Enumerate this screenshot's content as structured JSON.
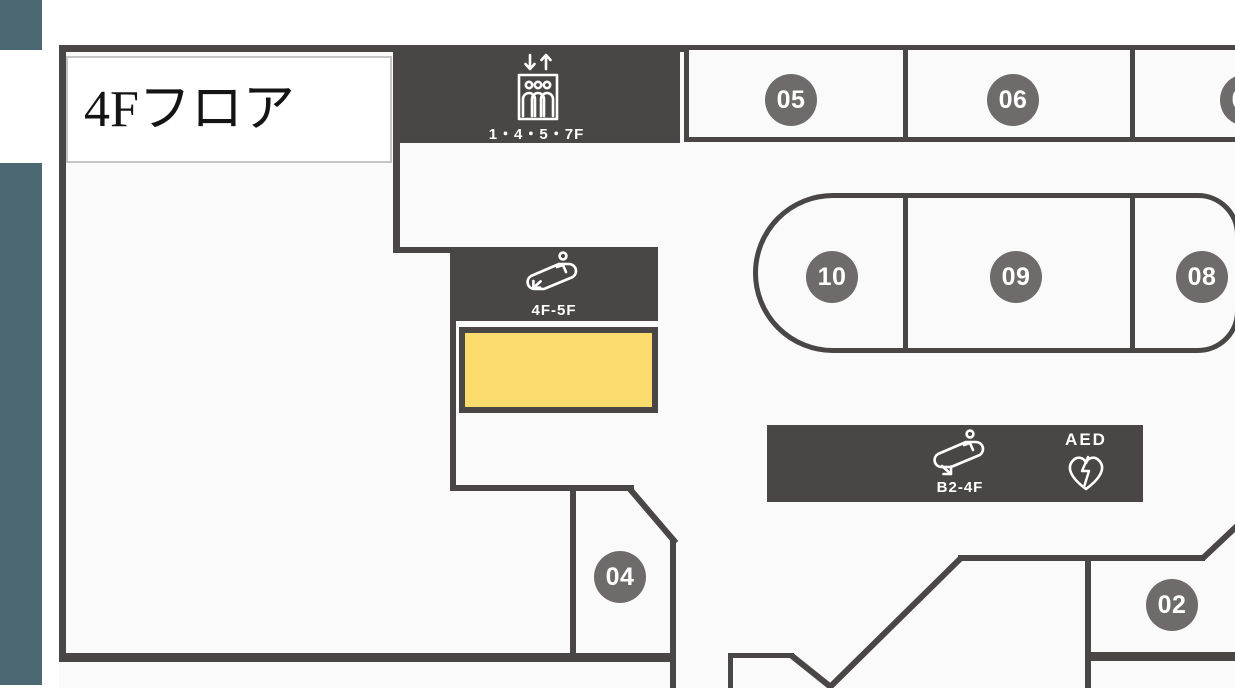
{
  "title": "4Fフロア",
  "areas": [
    {
      "id": "05",
      "label": "05"
    },
    {
      "id": "06",
      "label": "06"
    },
    {
      "id": "07",
      "label": "07"
    },
    {
      "id": "10",
      "label": "10"
    },
    {
      "id": "09",
      "label": "09"
    },
    {
      "id": "08",
      "label": "08"
    },
    {
      "id": "04",
      "label": "04"
    },
    {
      "id": "02",
      "label": "02"
    }
  ],
  "facilities": {
    "elevator": {
      "icon": "elevator-icon",
      "floors_label": "1・4・5・7F"
    },
    "escalator_upper": {
      "icon": "escalator-up-icon",
      "floors_label": "4F-5F"
    },
    "escalator_lower": {
      "icon": "escalator-down-icon",
      "floors_label": "B2-4F"
    },
    "aed": {
      "icon": "aed-icon",
      "label": "AED"
    }
  },
  "colors": {
    "wall": "#4a4645",
    "badge": "#6f6b6a",
    "highlight": "#fcdc6d",
    "sidebar_teal": "#4c6973",
    "floor": "#fafafa"
  }
}
